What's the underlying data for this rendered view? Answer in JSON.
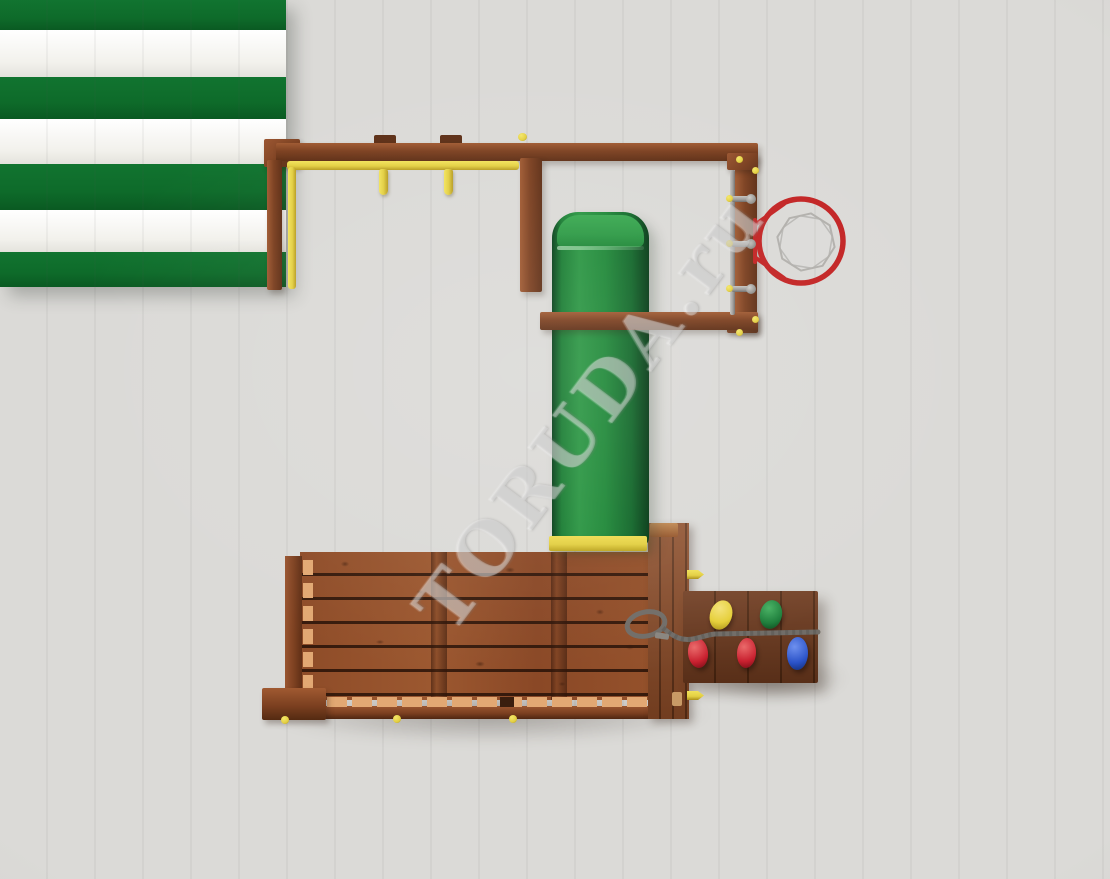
{
  "watermark": {
    "text": "TORUDA.ru"
  },
  "colors": {
    "background": "#dbdad7",
    "wood": "#7c4020",
    "deck_plank": "#94512b",
    "baluster": "#e2a873",
    "canopy_green": "#0e6b2a",
    "canopy_white": "#f2f1ec",
    "slide_green": "#1f8838",
    "slide_green_light": "#2d9a45",
    "accent_yellow": "#e3cf42",
    "ring_red": "#c32424",
    "net_gray": "#b2b0ac",
    "metal_gray": "#9b9997",
    "rope_gray": "#716d68",
    "hold_yellow": "#e6cf3a",
    "hold_green": "#1f7e3c",
    "hold_red": "#c8202f",
    "hold_blue": "#2a52c8"
  },
  "structure": {
    "swing_hangers": 2,
    "climbing_rungs": 3,
    "canopy_stripes": [
      "green",
      "white",
      "green",
      "white",
      "green",
      "white",
      "green"
    ],
    "climbing_hold_colors": [
      "yellow",
      "green",
      "red",
      "red",
      "blue"
    ],
    "deck_plank_rows": 6
  }
}
